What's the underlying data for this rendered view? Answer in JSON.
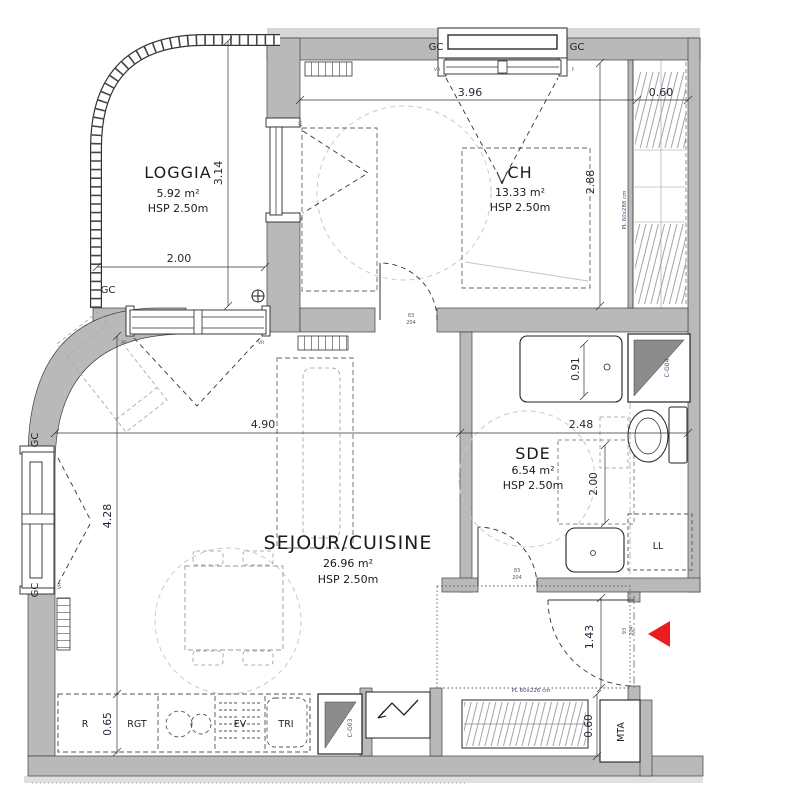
{
  "rooms": {
    "loggia": {
      "name": "LOGGIA",
      "area": "5.92 m²",
      "ceiling": "HSP 2.50m"
    },
    "ch": {
      "name": "CH",
      "area": "13.33 m²",
      "ceiling": "HSP 2.50m"
    },
    "sejour": {
      "name": "SEJOUR/CUISINE",
      "area": "26.96 m²",
      "ceiling": "HSP 2.50m"
    },
    "sde": {
      "name": "SDE",
      "area": "6.54 m²",
      "ceiling": "HSP 2.50m"
    }
  },
  "dimensions": {
    "ch_width": "3.96",
    "closet_depth": "0.60",
    "ch_height": "2.88",
    "loggia_depth": "3.14",
    "loggia_width": "2.00",
    "sejour_width": "4.90",
    "sde_width": "2.48",
    "sejour_height": "4.28",
    "sde_clear": "2.00",
    "shower_width": "0.91",
    "entry_width": "1.43",
    "counter_depth": "0.65",
    "closet_low_depth": "0.60"
  },
  "doors": {
    "ch": {
      "w": "83",
      "h": "204"
    },
    "sde": {
      "w": "83",
      "h": "204"
    },
    "entry": {
      "w": "93",
      "h": "204"
    }
  },
  "annotations": {
    "gc": "GC",
    "vr": "VR",
    "pf": "PF",
    "f": "F",
    "closet_tall": "PL 60x288 cm",
    "closet_low": "PL 60x226 cm",
    "duct_top": "C-G04",
    "duct_bottom": "C-G03",
    "washer": "LL",
    "meter": "MTA",
    "fridge": "R",
    "storage": "RGT",
    "sink": "EV",
    "waste": "TRI"
  },
  "colors": {
    "wall": "#b9b9b9",
    "wall_trim": "#d6d6d6",
    "line": "#2a2a2a",
    "dim_text": "#232b38",
    "annotation_text": "#3f4c7a",
    "duct_fill": "#8c8c8c",
    "entry_arrow": "#ed1c1c",
    "guide": "#c9c9c9"
  }
}
